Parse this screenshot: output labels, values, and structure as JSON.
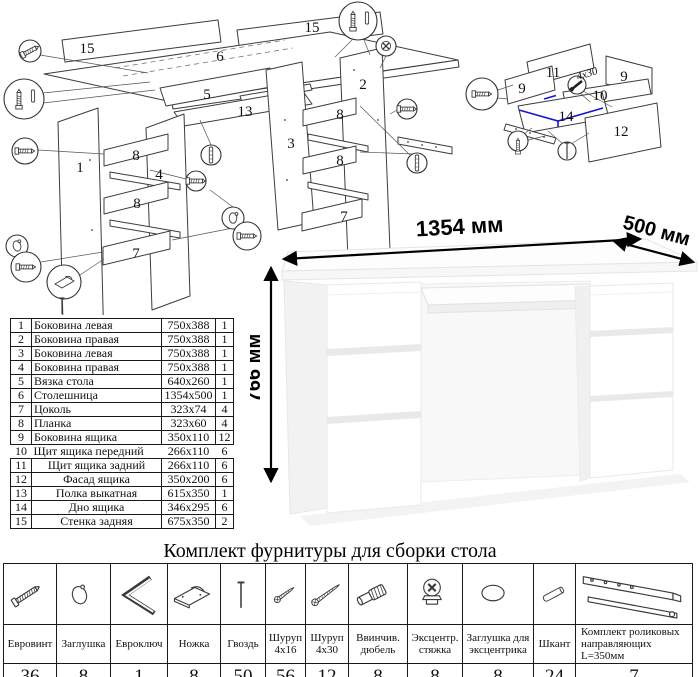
{
  "exploded_main": {
    "labels": {
      "n15a": "15",
      "n15b": "15",
      "n6": "6",
      "n5": "5",
      "n13": "13",
      "n3": "3",
      "n2": "2",
      "n1": "1",
      "n4": "4",
      "n8a": "8",
      "n8b": "8",
      "n8c": "8",
      "n8d": "8",
      "n7a": "7",
      "n7b": "7"
    }
  },
  "exploded_drawer": {
    "labels": {
      "n11": "11",
      "n9a": "9",
      "n9b": "9",
      "n10": "10",
      "n14": "14",
      "n12": "12"
    },
    "annotation": "4x30"
  },
  "desk_figure": {
    "width_label": "1354 мм",
    "depth_label": "500 мм",
    "height_label": "766 мм"
  },
  "parts_table": {
    "rows": [
      {
        "num": "1",
        "name": "Боковина левая",
        "size": "750x388",
        "qty": "1"
      },
      {
        "num": "2",
        "name": "Боковина правая",
        "size": "750x388",
        "qty": "1"
      },
      {
        "num": "3",
        "name": "Боковина левая",
        "size": "750x388",
        "qty": "1"
      },
      {
        "num": "4",
        "name": "Боковина правая",
        "size": "750x388",
        "qty": "1"
      },
      {
        "num": "5",
        "name": "Вязка стола",
        "size": "640x260",
        "qty": "1"
      },
      {
        "num": "6",
        "name": "Столешница",
        "size": "1354x500",
        "qty": "1"
      },
      {
        "num": "7",
        "name": "Цоколь",
        "size": "323x74",
        "qty": "4"
      },
      {
        "num": "8",
        "name": "Планка",
        "size": "323x60",
        "qty": "4"
      },
      {
        "num": "9",
        "name": "Боковина ящика",
        "size": "350x110",
        "qty": "12"
      },
      {
        "num": "10",
        "name": "Щит ящика передний",
        "size": "266x110",
        "qty": "6"
      },
      {
        "num": "11",
        "name": "Щит ящика задний",
        "size": "266x110",
        "qty": "6"
      },
      {
        "num": "12",
        "name": "Фасад ящика",
        "size": "350x200",
        "qty": "6"
      },
      {
        "num": "13",
        "name": "Полка выкатная",
        "size": "615x350",
        "qty": "1"
      },
      {
        "num": "14",
        "name": "Дно ящика",
        "size": "346x295",
        "qty": "6"
      },
      {
        "num": "15",
        "name": "Стенка задняя",
        "size": "675x350",
        "qty": "2"
      }
    ]
  },
  "hardware": {
    "title": "Комплект фурнитуры для сборки стола",
    "items": [
      {
        "icon": "euro-screw",
        "name": "Евровинт",
        "qty": "36"
      },
      {
        "icon": "cap",
        "name": "Заглушка",
        "qty": "8"
      },
      {
        "icon": "hex-key",
        "name": "Евроключ",
        "qty": "1"
      },
      {
        "icon": "foot",
        "name": "Ножка",
        "qty": "8"
      },
      {
        "icon": "nail",
        "name": "Гвоздь",
        "qty": "50"
      },
      {
        "icon": "screw-4x16",
        "name": "Шуруп 4x16",
        "qty": "56"
      },
      {
        "icon": "screw-4x30",
        "name": "Шуруп 4x30",
        "qty": "12"
      },
      {
        "icon": "screw-dowel",
        "name": "Ввинчив. дюбель",
        "qty": "8"
      },
      {
        "icon": "cam-lock",
        "name": "Эксцентр. стяжка",
        "qty": "8"
      },
      {
        "icon": "cam-cap",
        "name": "Заглушка для эксцентрика",
        "qty": "8"
      },
      {
        "icon": "wood-dowel",
        "name": "Шкант",
        "qty": "24"
      },
      {
        "icon": "roller-guides",
        "name": "Комплект роликовых направляющих L=350мм",
        "qty": "7"
      }
    ]
  }
}
